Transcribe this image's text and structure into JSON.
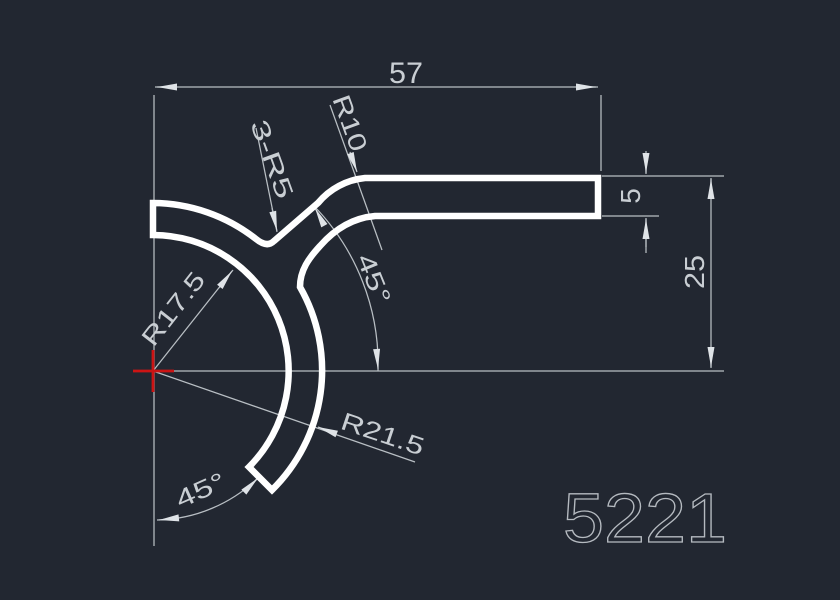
{
  "title": "CAD profile section drawing",
  "canvas": {
    "background": "#222731",
    "part_color": "#ffffff",
    "dimension_color": "#b9bfc4",
    "text_color": "#c9ced3",
    "center_mark_color": "#cc1414",
    "part_number_color": "#b5bac0"
  },
  "labels": {
    "overall_width": "57",
    "bar_thickness": "5",
    "right_height": "25",
    "fillet_note": "3-R5",
    "top_fillet_radius": "R10",
    "inner_radius": "R17.5",
    "outer_radius": "R21.5",
    "upper_angle": "45°",
    "lower_angle": "45°",
    "part_number": "5221"
  }
}
